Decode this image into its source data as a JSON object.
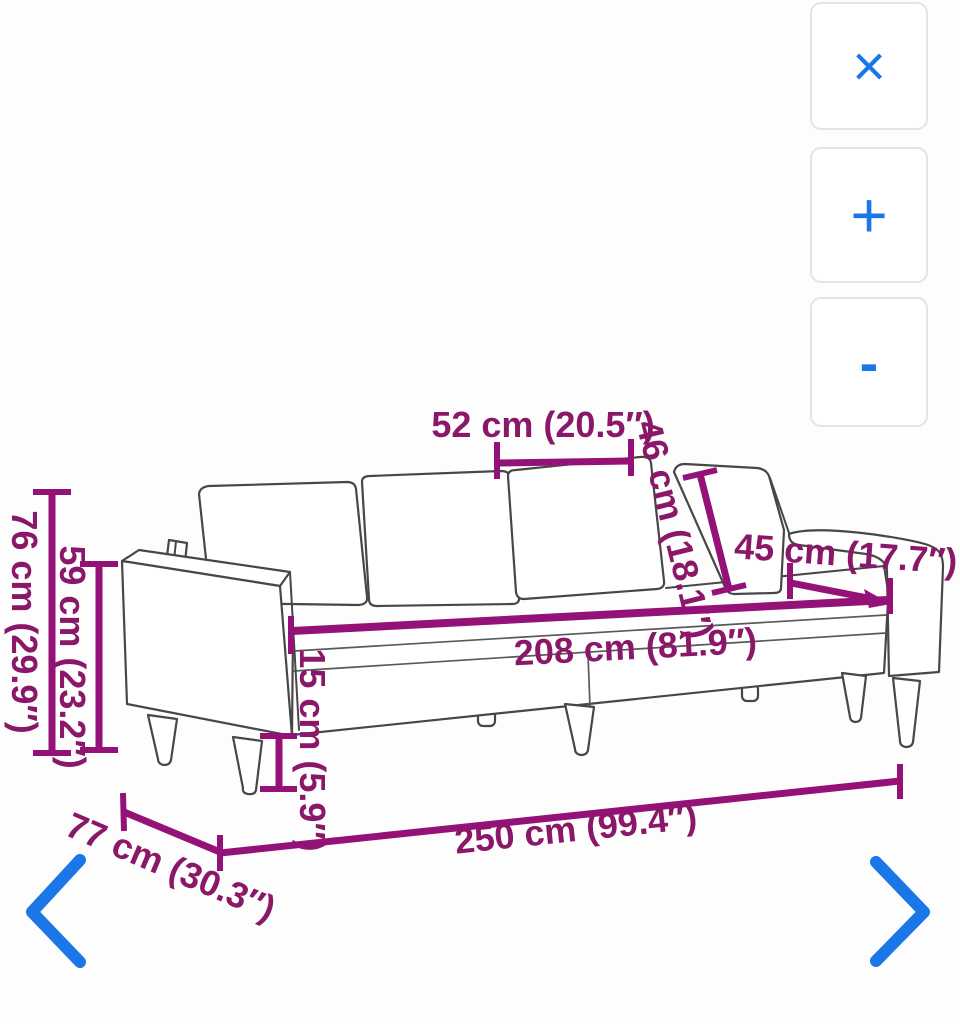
{
  "image_viewer": {
    "controls": {
      "close": "×",
      "zoom_in": "+",
      "zoom_out": "-"
    }
  },
  "dimensions": {
    "seat_cushion_width": "52 cm (20.5″)",
    "back_cushion_height": "46 cm (18.1″)",
    "seat_depth": "45 cm (17.7″)",
    "inner_width": "208 cm (81.9″)",
    "total_height": "76 cm (29.9″)",
    "arm_height": "59 cm (23.2″)",
    "leg_height": "15 cm (5.9″)",
    "total_width": "250 cm (99.4″)",
    "total_depth": "77 cm (30.3″)"
  },
  "colors": {
    "dimension_line": "#941277",
    "dimension_text": "#8b1769",
    "icon_blue": "#1b76e8",
    "sofa_outline": "#474747",
    "button_border": "#e4e4e4"
  }
}
